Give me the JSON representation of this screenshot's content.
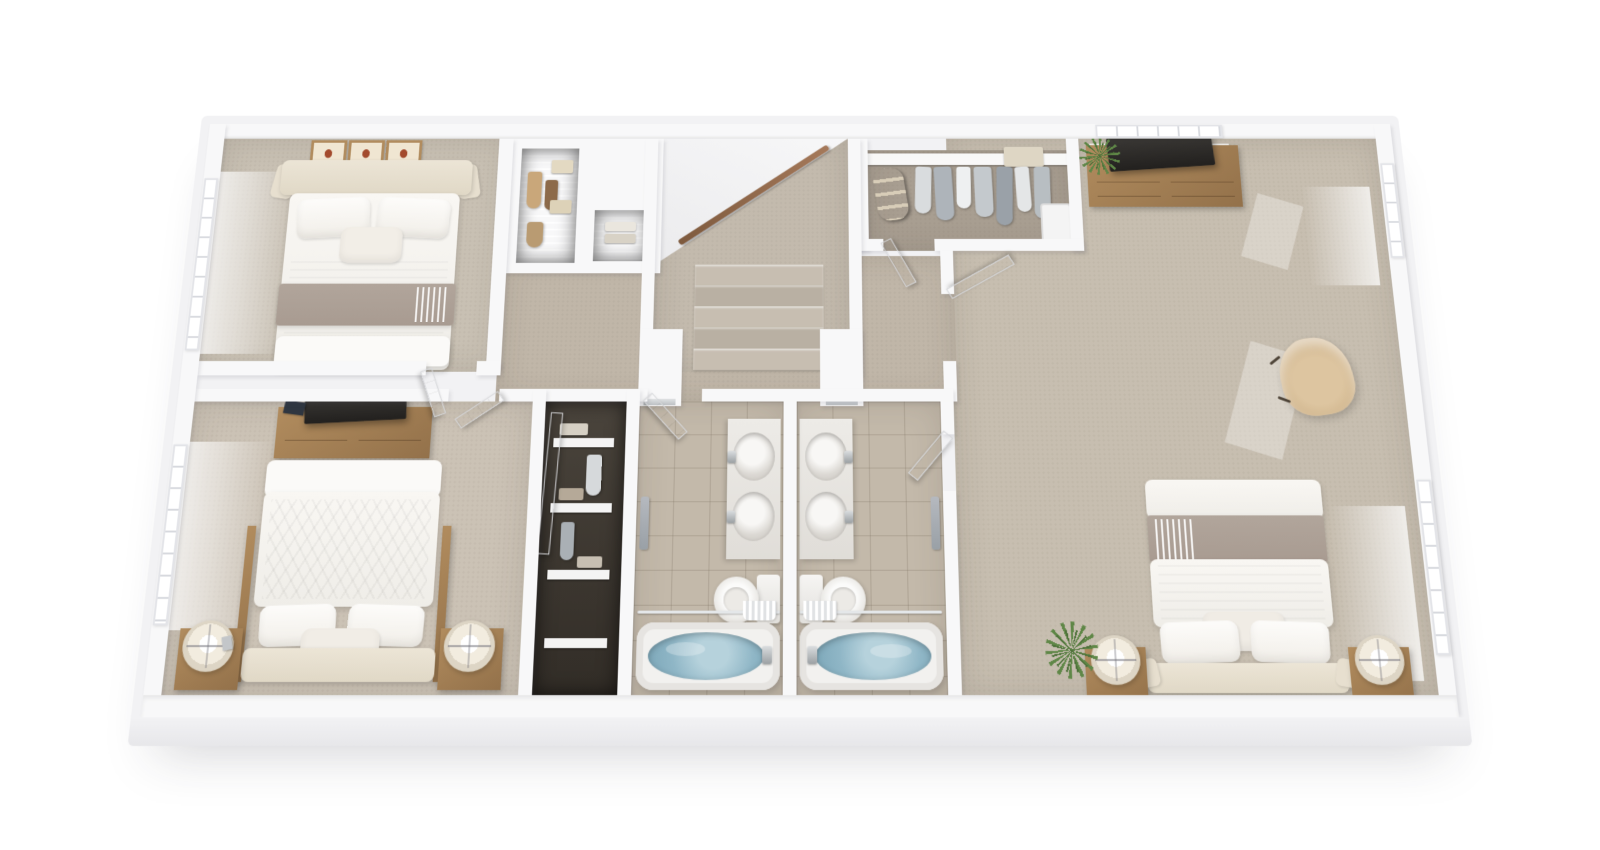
{
  "page": {
    "background": "#ffffff",
    "aria_label": "3D rendered floor plan of an upper residential level, bird's-eye perspective view"
  },
  "palette": {
    "bg": "#ffffff",
    "slab": "#f2f2f4",
    "slab-lip": "#e7e7ea",
    "wall": "#f8f8f9",
    "carpet-1": "#c8c0b3",
    "carpet-2": "#cbc2b5",
    "carpet-hall": "#c0b6a8",
    "carpet-master": "#c7beb0",
    "carpet-stairs": "#c3baad",
    "carpet-walkin": "#a89e91",
    "step-a": "#c7beb1",
    "step-b": "#b9b0a3",
    "tile": "#c3b9aa",
    "grout": "rgba(118,106,90,0.28)",
    "closet-dark": "#322d27",
    "wood": "#b18c5e",
    "wood-dark": "#93714a",
    "blanket": "#a89b91",
    "water": "#8fb6c6",
    "water-deep": "#7ba6b8",
    "plant": "#5f8747",
    "plant-dark": "#4c7038",
    "art": "#a34a2c",
    "tv": "#22201e",
    "glow": "rgba(255,255,255,0.75)"
  },
  "rooms": {
    "bedroom_front": {
      "label": "Front bedroom with upholstered bed, three framed prints and side window"
    },
    "reach_in_closet": {
      "label": "Reach-in closet with wire shelving and hanging clothes"
    },
    "linen_closet": {
      "label": "Linen closet with wire shelving"
    },
    "stairwell": {
      "label": "Carpeted staircase with wood handrail"
    },
    "hallway": {
      "label": "Hallway landing"
    },
    "walk_in_closet": {
      "label": "Walk-in closet with hanging clothes, duffel bag and storage"
    },
    "primary_bedroom": {
      "label": "Primary bedroom with bed, nightstands, dresser with TV, armchair and plant"
    },
    "rear_bedroom": {
      "label": "Rear bedroom with platform bed, dresser with TV and nightstand lamps"
    },
    "hall_closet": {
      "label": "Hall closet with wire shelving"
    },
    "bathroom_left": {
      "label": "Bathroom with double vanity, toilet and tub with shower curtain"
    },
    "bathroom_right": {
      "label": "Bathroom with double vanity, toilet and tub with shower curtain"
    }
  }
}
